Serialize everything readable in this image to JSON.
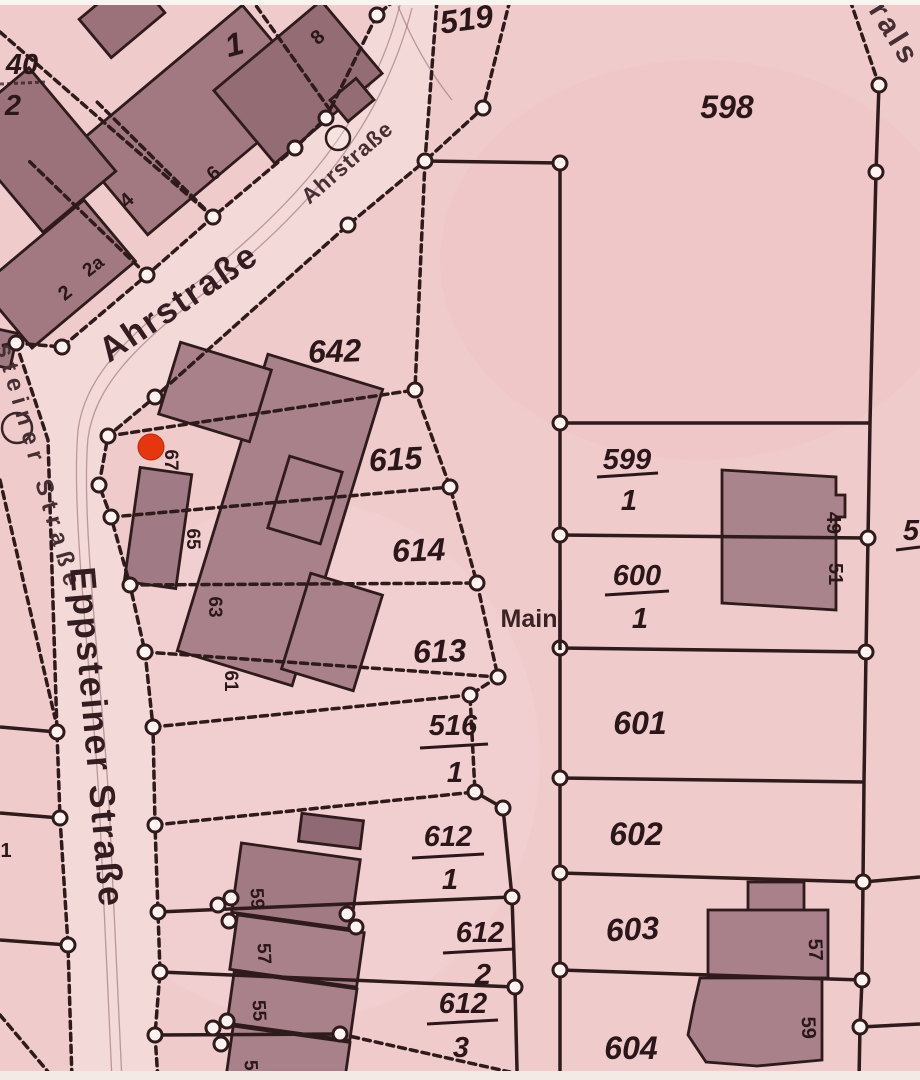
{
  "map_type": "cadastral-map",
  "streets": {
    "ahr_small": "Ahrstraße",
    "ahr_large": "Ahrstraße",
    "epp_small": "steiner Straße",
    "epp_large": "Eppsteiner Straße",
    "main_partial": "Main",
    "corner_partial": "rals"
  },
  "parcels": {
    "p1": "1",
    "p40_num": "40",
    "p40_den": "2",
    "p519": "519",
    "p598": "598",
    "p642": "642",
    "p615": "615",
    "p614": "614",
    "p613": "613",
    "p599_num": "599",
    "p599_den": "1",
    "p600_num": "600",
    "p600_den": "1",
    "p601": "601",
    "p602": "602",
    "p603": "603",
    "p604": "604",
    "p516_num": "516",
    "p516_den": "1",
    "p612_1_num": "612",
    "p612_1_den": "1",
    "p612_2_num": "612",
    "p612_2_den": "2",
    "p612_3_num": "612",
    "p612_3_den": "3",
    "edge_one": "1",
    "edge_partial": "5"
  },
  "houses": {
    "h8": "8",
    "h6": "6",
    "h4": "4",
    "h2a": "2a",
    "h2": "2",
    "h67": "67",
    "h65": "65",
    "h63": "63",
    "h61": "61",
    "h59": "59",
    "h57": "57",
    "h55": "55",
    "h53": "53",
    "h49": "49",
    "h51": "51",
    "h57_b": "57",
    "h59_b": "59"
  },
  "marker": {
    "color": "#e6360f"
  },
  "colors": {
    "background": "#f0cbcc",
    "street": "#f4d9d9",
    "building": "#a9818a",
    "line": "#2f1b1b",
    "text": "#2b171a"
  }
}
